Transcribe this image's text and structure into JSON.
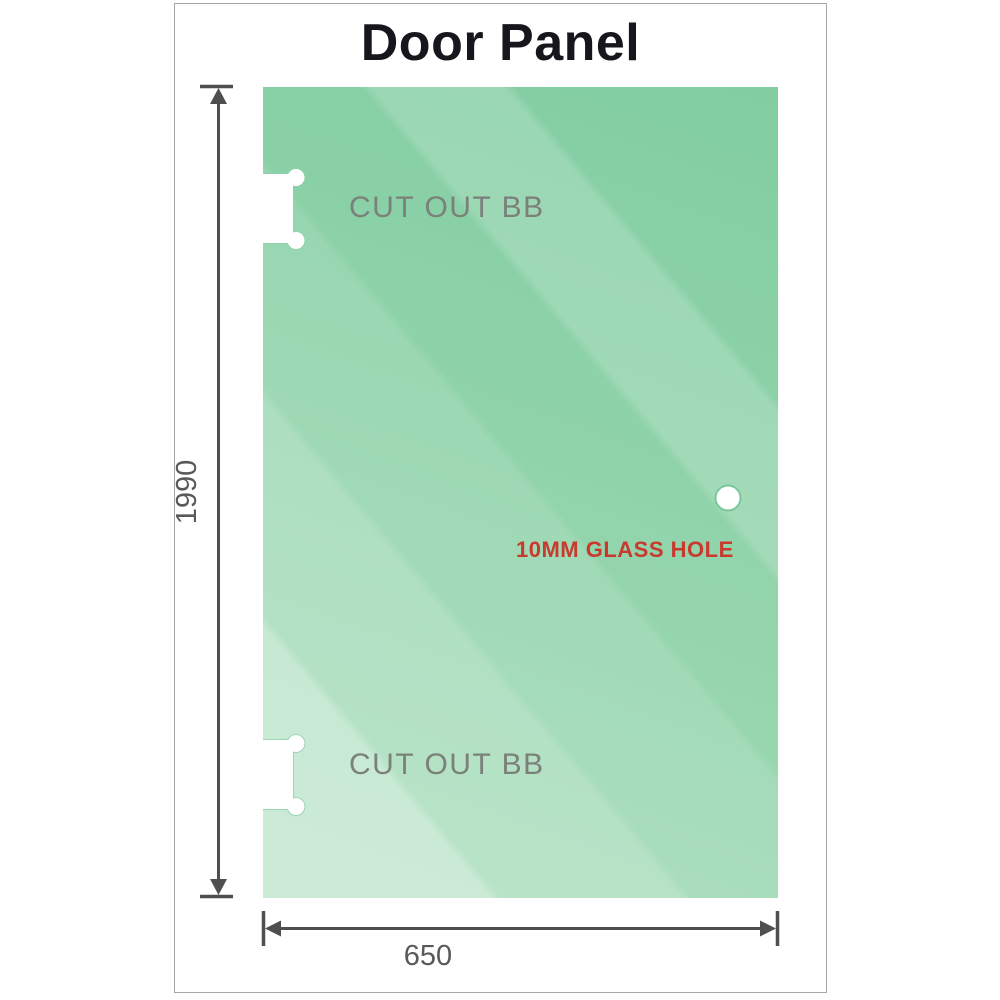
{
  "title": "Door Panel",
  "panel": {
    "height_mm": "1990",
    "width_mm": "650",
    "cutouts": {
      "top_label": "CUT OUT BB",
      "bottom_label": "CUT OUT BB"
    },
    "hole": {
      "label": "10MM GLASS HOLE"
    }
  },
  "colors": {
    "background": "#ffffff",
    "frame_border": "#a6a6a6",
    "title_text": "#16161c",
    "glass_base_dark": "#82cda2",
    "glass_base_light": "#a5dcb8",
    "cutout_outline": "#8ed0ab",
    "hole_ring": "#7cc79c",
    "dimension_line": "#4f4f4f",
    "dimension_text": "#58595b",
    "cutout_label": "#7b807b",
    "hole_label": "#c8392e"
  }
}
